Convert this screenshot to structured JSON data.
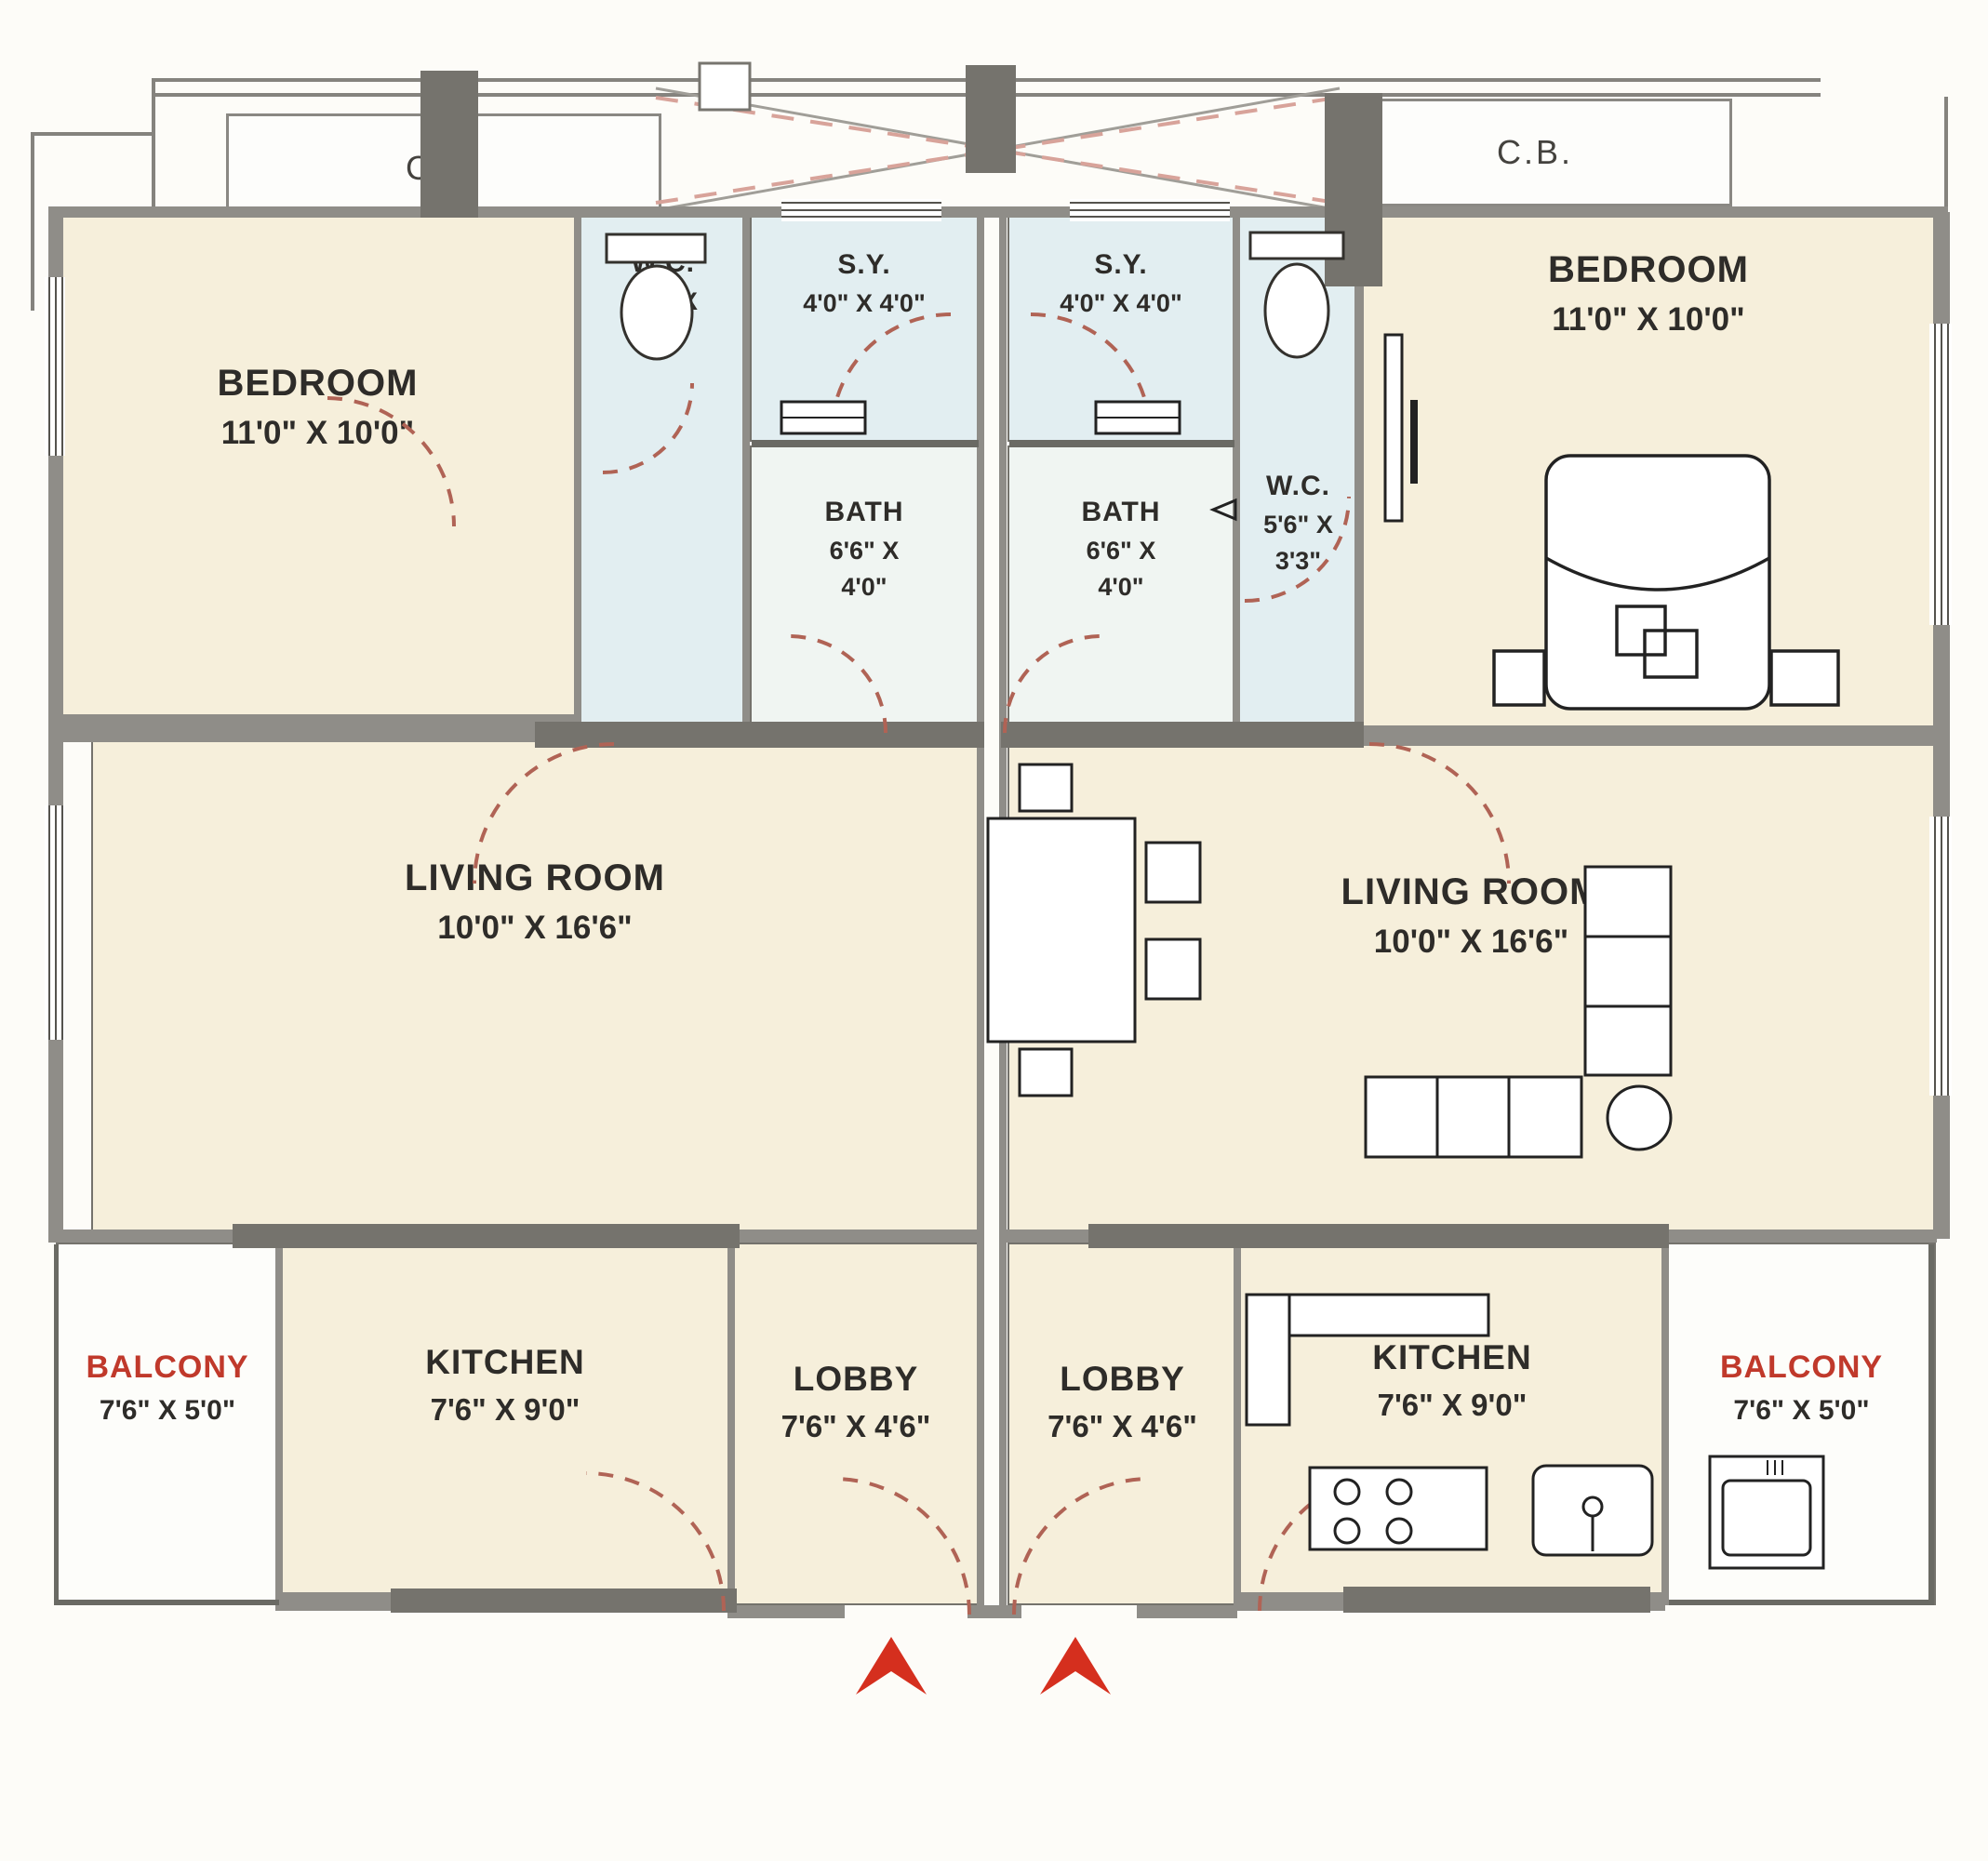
{
  "plan": {
    "kind": "residential floor plan, two mirrored units",
    "colors": {
      "wall_gray": "#8f8d88",
      "wall_dark": "#75736d",
      "room_cream": "#f6efdb",
      "wet_area_blue": "#e2eef1",
      "balcony_text_red": "#c0392b",
      "entry_arrow_red": "#d52f1e",
      "door_arc_dashed": "#b06355",
      "label_text": "#2e2c29"
    },
    "top": {
      "cb_left": "C.B.",
      "cb_right": "C.B."
    },
    "units": {
      "left": {
        "bedroom_name": "BEDROOM",
        "bedroom_dims": "11'0\" X 10'0\"",
        "wc_name": "W.C.",
        "wc_dims1": "5'6\" X",
        "wc_dims2": "3'3\"",
        "sy_name": "S.Y.",
        "sy_dims": "4'0\" X 4'0\"",
        "bath_name": "BATH",
        "bath_dims1": "6'6\" X",
        "bath_dims2": "4'0\"",
        "living_name": "LIVING ROOM",
        "living_dims": "10'0\" X 16'6\"",
        "balcony_name": "BALCONY",
        "balcony_dims": "7'6\" X 5'0\"",
        "kitchen_name": "KITCHEN",
        "kitchen_dims": "7'6\" X 9'0\"",
        "lobby_name": "LOBBY",
        "lobby_dims": "7'6\" X 4'6\""
      },
      "right": {
        "bedroom_name": "BEDROOM",
        "bedroom_dims": "11'0\" X 10'0\"",
        "wc_name": "W.C.",
        "wc_dims1": "5'6\" X",
        "wc_dims2": "3'3\"",
        "sy_name": "S.Y.",
        "sy_dims": "4'0\" X 4'0\"",
        "bath_name": "BATH",
        "bath_dims1": "6'6\" X",
        "bath_dims2": "4'0\"",
        "living_name": "LIVING ROOM",
        "living_dims": "10'0\" X 16'6\"",
        "balcony_name": "BALCONY",
        "balcony_dims": "7'6\" X 5'0\"",
        "kitchen_name": "KITCHEN",
        "kitchen_dims": "7'6\" X 9'0\"",
        "lobby_name": "LOBBY",
        "lobby_dims": "7'6\" X 4'6\""
      }
    }
  }
}
